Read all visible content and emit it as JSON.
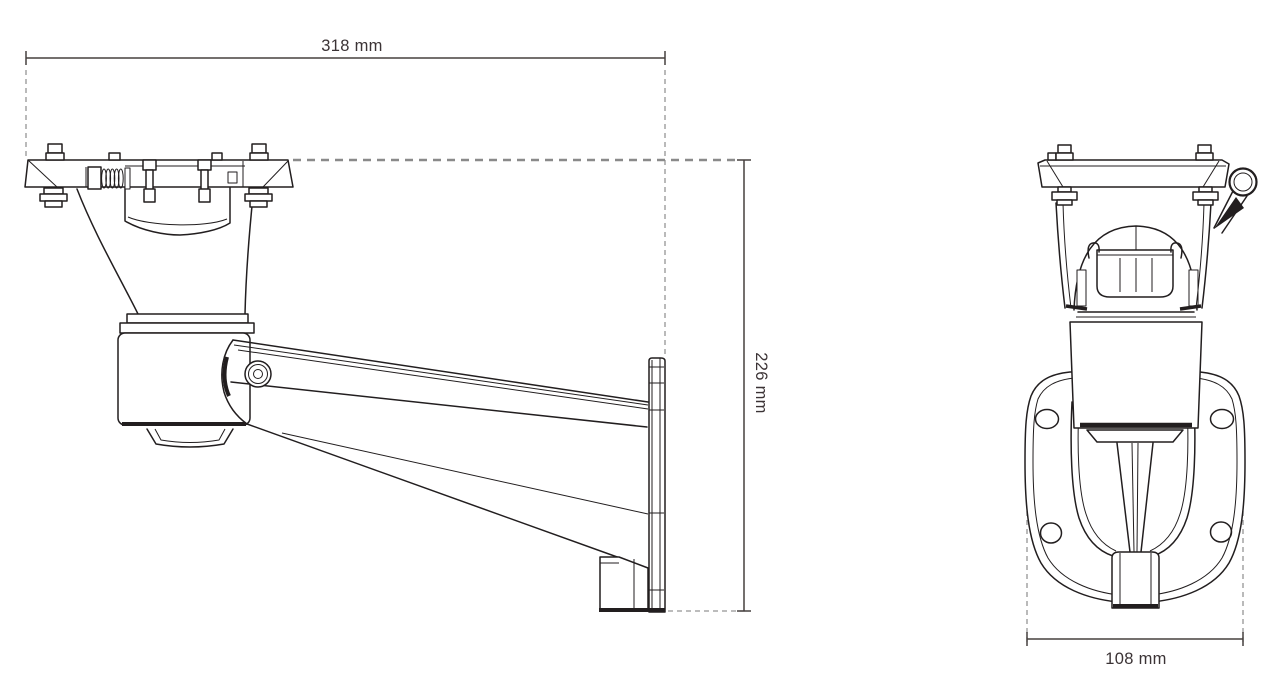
{
  "dimensions": {
    "overall_length": {
      "label": "318 mm"
    },
    "overall_height": {
      "label": "226 mm"
    },
    "base_width": {
      "label": "108 mm"
    }
  },
  "colors": {
    "background": "#ffffff",
    "line": "#221e1f",
    "dimension_line": "#46403f",
    "extension_dash": "#949494"
  }
}
